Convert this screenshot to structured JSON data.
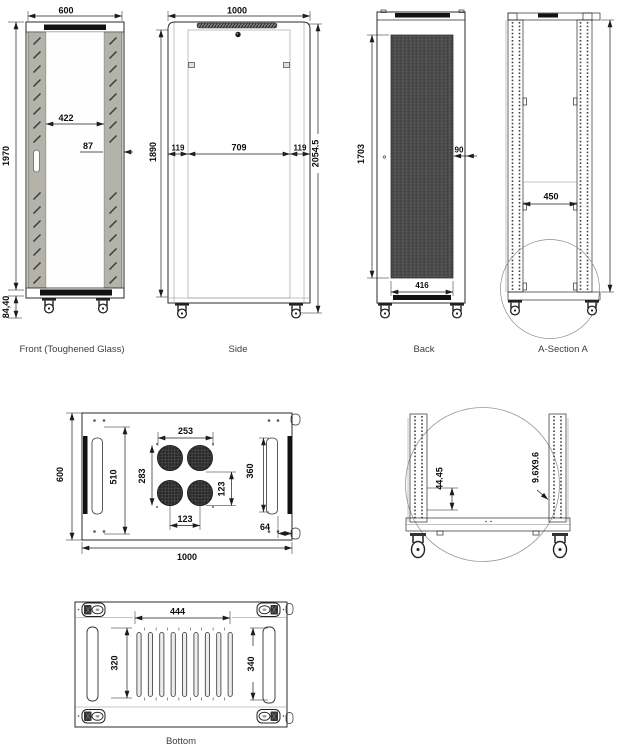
{
  "captions": {
    "front": "Front (Toughened Glass)",
    "side": "Side",
    "back": "Back",
    "section": "A-Section A",
    "bottom": "Bottom"
  },
  "front": {
    "top_width": "600",
    "glass_width": "422",
    "frame_width": "87",
    "height": "1970",
    "base_height": "84,40"
  },
  "side": {
    "top_width": "1000",
    "height": "1890",
    "left_inset": "119",
    "door_width": "709",
    "right_inset": "119",
    "total_height": "2054.5"
  },
  "back": {
    "mesh_height": "1703",
    "side_offset": "90",
    "mesh_width": "416"
  },
  "section": {
    "inner_width": "450"
  },
  "top_view": {
    "depth": "600",
    "slot_length": "510",
    "fan_group_width": "253",
    "fan_group_height": "283",
    "fan_pitch_v": "123",
    "fan_pitch_h": "123",
    "right_span": "360",
    "edge_offset": "64",
    "width": "1000"
  },
  "detail_view": {
    "hole_pitch": "44.45",
    "hole_size": "9.6X9.6"
  },
  "bottom_view": {
    "vent_width": "444",
    "slot_left_length": "320",
    "slot_right_length": "340"
  },
  "colors": {
    "line": "#1d1d1d",
    "panel_gray": "#b3b3aa",
    "black_strip": "#121212",
    "mesh": "#4a4a4a",
    "background": "#ffffff"
  }
}
